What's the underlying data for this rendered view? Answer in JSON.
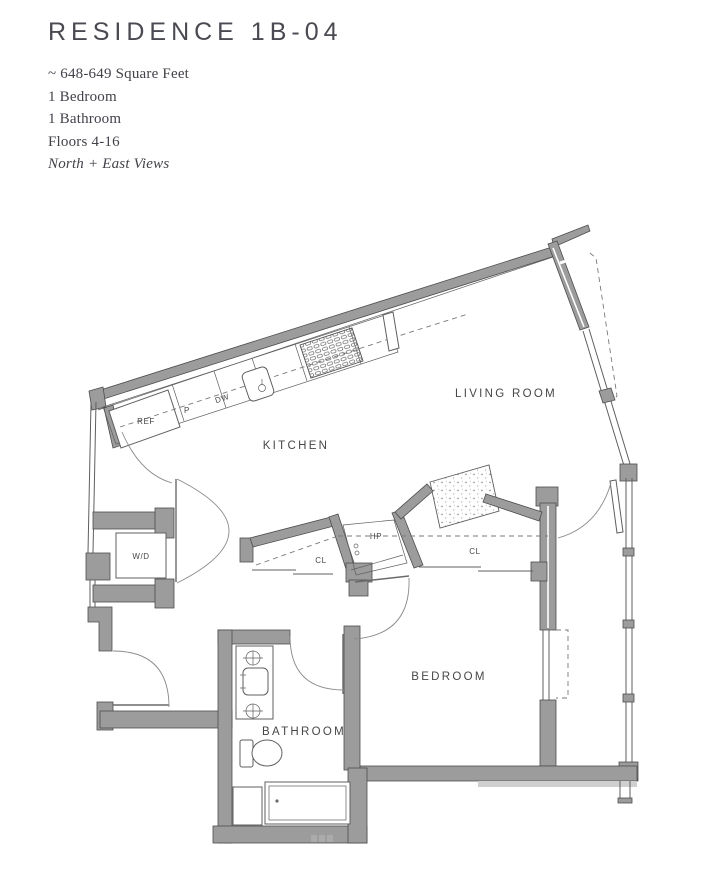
{
  "header": {
    "title": "RESIDENCE 1B-04",
    "sqft": "~ 648-649 Square Feet",
    "bedrooms": "1 Bedroom",
    "bathrooms": "1 Bathroom",
    "floors": "Floors 4-16",
    "views": "North + East Views"
  },
  "plan": {
    "rooms": {
      "kitchen": "KITCHEN",
      "living_room": "LIVING ROOM",
      "bedroom": "BEDROOM",
      "bathroom": "BATHROOM"
    },
    "labels": {
      "washer_dryer": "W/D",
      "refrigerator": "REF",
      "pantry": "P",
      "dishwasher": "DW",
      "heat_pump": "HP",
      "closet_left": "CL",
      "closet_right": "CL"
    }
  },
  "colors": {
    "wall-fill": "#9c9c9c",
    "wall-stroke": "#4d4d4d",
    "line": "#5f5f5f",
    "dash": "#7a7a7a",
    "label": "#474747",
    "title": "#4a4a52",
    "spec": "#42424a"
  }
}
